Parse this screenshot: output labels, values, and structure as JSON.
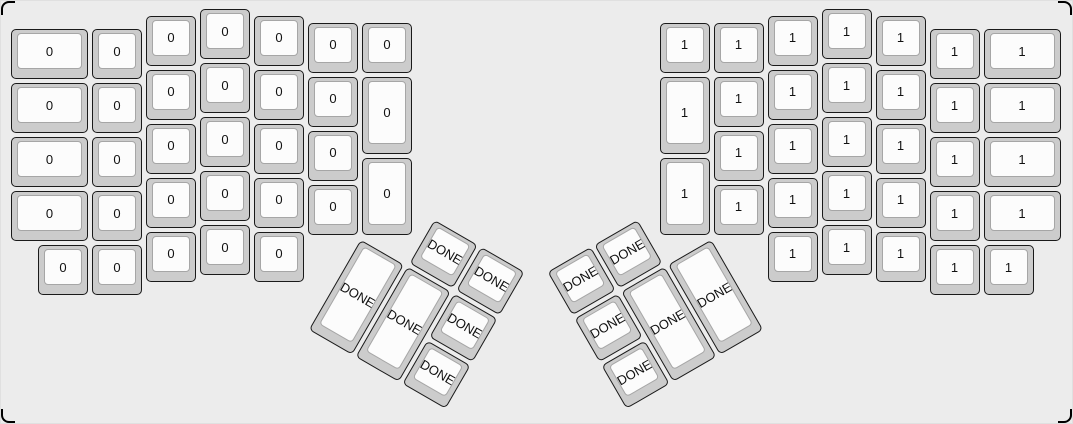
{
  "canvas": {
    "background": "#ececec",
    "frame_color": "#000000"
  },
  "key_style": {
    "cap_color": "#cccccc",
    "cap_border_color": "#1a1a1a",
    "top_color": "#fcfcfc",
    "top_border_color": "#a6a6a6",
    "label_color": "#111111"
  },
  "unit_px": 54,
  "key_inset_px": 2,
  "key_groups": {
    "left_main": {
      "key_label": "0",
      "origin_x": 8,
      "origin_y": 6,
      "rotation_deg": 0,
      "keys": [
        [
          0,
          0.375,
          1.5,
          1
        ],
        [
          0,
          1.375,
          1.5,
          1
        ],
        [
          0,
          2.375,
          1.5,
          1
        ],
        [
          0,
          3.375,
          1.5,
          1
        ],
        [
          0.5,
          4.375,
          1,
          1
        ],
        [
          1.5,
          0.375,
          1,
          1
        ],
        [
          1.5,
          1.375,
          1,
          1
        ],
        [
          1.5,
          2.375,
          1,
          1
        ],
        [
          1.5,
          3.375,
          1,
          1
        ],
        [
          1.5,
          4.375,
          1,
          1
        ],
        [
          2.5,
          0.125,
          1,
          1
        ],
        [
          2.5,
          1.125,
          1,
          1
        ],
        [
          2.5,
          2.125,
          1,
          1
        ],
        [
          2.5,
          3.125,
          1,
          1
        ],
        [
          2.5,
          4.125,
          1,
          1
        ],
        [
          3.5,
          0,
          1,
          1
        ],
        [
          3.5,
          1,
          1,
          1
        ],
        [
          3.5,
          2,
          1,
          1
        ],
        [
          3.5,
          3,
          1,
          1
        ],
        [
          3.5,
          4,
          1,
          1
        ],
        [
          4.5,
          0.125,
          1,
          1
        ],
        [
          4.5,
          1.125,
          1,
          1
        ],
        [
          4.5,
          2.125,
          1,
          1
        ],
        [
          4.5,
          3.125,
          1,
          1
        ],
        [
          4.5,
          4.125,
          1,
          1
        ],
        [
          5.5,
          0.25,
          1,
          1
        ],
        [
          5.5,
          1.25,
          1,
          1
        ],
        [
          5.5,
          2.25,
          1,
          1
        ],
        [
          5.5,
          3.25,
          1,
          1
        ],
        [
          6.5,
          0.25,
          1,
          1
        ],
        [
          6.5,
          1.25,
          1,
          1.5
        ],
        [
          6.5,
          2.75,
          1,
          1.5
        ]
      ]
    },
    "right_main": {
      "key_label": "1",
      "origin_x": 656.5,
      "origin_y": 6,
      "rotation_deg": 0,
      "keys": [
        [
          0,
          0.25,
          1,
          1
        ],
        [
          0,
          1.25,
          1,
          1.5
        ],
        [
          0,
          2.75,
          1,
          1.5
        ],
        [
          1,
          0.25,
          1,
          1
        ],
        [
          1,
          1.25,
          1,
          1
        ],
        [
          1,
          2.25,
          1,
          1
        ],
        [
          1,
          3.25,
          1,
          1
        ],
        [
          2,
          0.125,
          1,
          1
        ],
        [
          2,
          1.125,
          1,
          1
        ],
        [
          2,
          2.125,
          1,
          1
        ],
        [
          2,
          3.125,
          1,
          1
        ],
        [
          2,
          4.125,
          1,
          1
        ],
        [
          3,
          0,
          1,
          1
        ],
        [
          3,
          1,
          1,
          1
        ],
        [
          3,
          2,
          1,
          1
        ],
        [
          3,
          3,
          1,
          1
        ],
        [
          3,
          4,
          1,
          1
        ],
        [
          4,
          0.125,
          1,
          1
        ],
        [
          4,
          1.125,
          1,
          1
        ],
        [
          4,
          2.125,
          1,
          1
        ],
        [
          4,
          3.125,
          1,
          1
        ],
        [
          4,
          4.125,
          1,
          1
        ],
        [
          5,
          0.375,
          1,
          1
        ],
        [
          5,
          1.375,
          1,
          1
        ],
        [
          5,
          2.375,
          1,
          1
        ],
        [
          5,
          3.375,
          1,
          1
        ],
        [
          5,
          4.375,
          1,
          1
        ],
        [
          6,
          0.375,
          1.5,
          1
        ],
        [
          6,
          1.375,
          1.5,
          1
        ],
        [
          6,
          2.375,
          1.5,
          1
        ],
        [
          6,
          3.375,
          1.5,
          1
        ],
        [
          6,
          4.375,
          1,
          1
        ]
      ]
    },
    "left_thumb": {
      "key_label": "DONE",
      "rotation_deg": 30,
      "center_x": 359,
      "center_y": 235.5,
      "keys": [
        [
          1,
          -1,
          1,
          1
        ],
        [
          2,
          -1,
          1,
          1
        ],
        [
          0,
          0,
          1,
          2
        ],
        [
          1,
          0,
          1,
          2
        ],
        [
          2,
          0,
          1,
          1
        ],
        [
          2,
          1,
          1,
          1
        ]
      ]
    },
    "right_thumb": {
      "key_label": "DONE",
      "rotation_deg": -30,
      "center_x": 710.5,
      "center_y": 235.5,
      "keys": [
        [
          -2,
          -1,
          1,
          1
        ],
        [
          -3,
          -1,
          1,
          1
        ],
        [
          -1,
          0,
          1,
          2
        ],
        [
          -2,
          0,
          1,
          2
        ],
        [
          -3,
          0,
          1,
          1
        ],
        [
          -3,
          1,
          1,
          1
        ]
      ]
    }
  }
}
